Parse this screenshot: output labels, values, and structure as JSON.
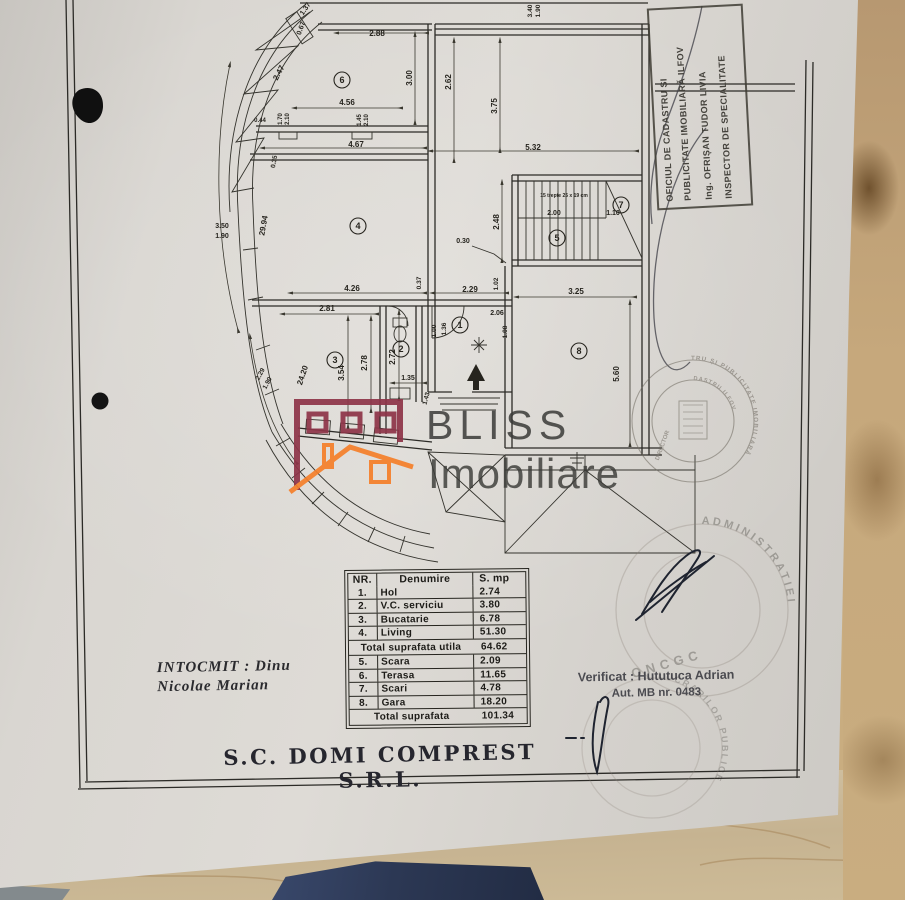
{
  "corner_stamp": {
    "line1": "OFICIUL DE CADASTRU ȘI",
    "line2": "PUBLICITATE IMOBILIARĂ ILFOV",
    "line3": "Ing. OFRIȘAN TUDOR LIVIA",
    "line4": "INSPECTOR DE SPECIALITATE"
  },
  "watermark": {
    "line1": "BLISS",
    "line2": "Imobiliare",
    "maroon": "#8e3448",
    "orange": "#f57f2a"
  },
  "table": {
    "headers": [
      "NR.",
      "Denumire",
      "S. mp"
    ],
    "rows": [
      {
        "nr": "1.",
        "name": "Hol",
        "mp": "2.74"
      },
      {
        "nr": "2.",
        "name": "V.C. serviciu",
        "mp": "3.80"
      },
      {
        "nr": "3.",
        "name": "Bucatarie",
        "mp": "6.78"
      },
      {
        "nr": "4.",
        "name": "Living",
        "mp": "51.30"
      }
    ],
    "subtotal": {
      "label": "Total suprafata utila",
      "mp": "64.62"
    },
    "rows2": [
      {
        "nr": "5.",
        "name": "Scara",
        "mp": "2.09"
      },
      {
        "nr": "6.",
        "name": "Terasa",
        "mp": "11.65"
      },
      {
        "nr": "7.",
        "name": "Scari",
        "mp": "4.78"
      },
      {
        "nr": "8.",
        "name": "Gara",
        "mp": "18.20"
      }
    ],
    "total": {
      "label": "Total suprafata",
      "mp": "101.34"
    }
  },
  "credits": {
    "intocmit_line1": "INTOCMIT : Dinu",
    "intocmit_line2": "Nicolae Marian",
    "verificat_line1": "Verificat : Hututuca Adrian",
    "verificat_line2": "Aut. MB nr. 0483"
  },
  "company": {
    "name": "S.C. DOMI COMPREST S.R.L."
  },
  "stamps": {
    "round1": {
      "outer": "AGENȚIA NAȚIONALĂ DE CADASTRU ȘI PUBLICITATE IMOBILIARĂ",
      "inner": "OFICIUL DE CADASTRU ILFOV",
      "center": "DIRECTOR"
    },
    "round2": {
      "arc": "ADMINISTRATIEI",
      "word": "ONCGC"
    },
    "round3": {
      "arc": "MINISTERUL LUCRARILOR PUBLICE"
    }
  },
  "plan": {
    "dimensions": [
      {
        "text": "1.37",
        "x": 307,
        "y": 10,
        "rot": -55,
        "size": 7
      },
      {
        "text": "0.67",
        "x": 303,
        "y": 29,
        "rot": -70,
        "size": 7
      },
      {
        "text": "2.88",
        "x": 377,
        "y": 36,
        "rot": 0
      },
      {
        "text": "2.47",
        "x": 281,
        "y": 74,
        "rot": -62
      },
      {
        "text": "3.00",
        "x": 412,
        "y": 78,
        "rot": -90
      },
      {
        "text": "2.62",
        "x": 451,
        "y": 82,
        "rot": -90
      },
      {
        "text": "3.75",
        "x": 497,
        "y": 106,
        "rot": -90
      },
      {
        "text": "3.40",
        "x": 532,
        "y": 11,
        "rot": -90,
        "size": 6.5
      },
      {
        "text": "1.90",
        "x": 540,
        "y": 11,
        "rot": -90,
        "size": 6.5
      },
      {
        "text": "4.56",
        "x": 347,
        "y": 105,
        "rot": 0
      },
      {
        "text": "1.70",
        "x": 282,
        "y": 119,
        "rot": -90,
        "size": 6
      },
      {
        "text": "2.10",
        "x": 289,
        "y": 119,
        "rot": -90,
        "size": 6
      },
      {
        "text": "1.45",
        "x": 361,
        "y": 120,
        "rot": -90,
        "size": 6
      },
      {
        "text": "2.10",
        "x": 368,
        "y": 120,
        "rot": -90,
        "size": 6
      },
      {
        "text": "0.44",
        "x": 260,
        "y": 122,
        "rot": 0,
        "size": 6
      },
      {
        "text": "4.67",
        "x": 356,
        "y": 147,
        "rot": 0
      },
      {
        "text": "5.32",
        "x": 533,
        "y": 150,
        "rot": 0
      },
      {
        "text": "0.35",
        "x": 276,
        "y": 162,
        "rot": -80,
        "size": 6.5
      },
      {
        "text": "3.50",
        "x": 222,
        "y": 228,
        "rot": 0,
        "size": 7
      },
      {
        "text": "1.90",
        "x": 222,
        "y": 238,
        "rot": 0,
        "size": 7
      },
      {
        "text": "29.94",
        "x": 266,
        "y": 226,
        "rot": -80
      },
      {
        "text": "2.48",
        "x": 499,
        "y": 222,
        "rot": -90
      },
      {
        "text": "15 trepte 25 x 19 cm",
        "x": 564,
        "y": 197,
        "rot": 0,
        "size": 5
      },
      {
        "text": "2.00",
        "x": 554,
        "y": 215,
        "rot": 0,
        "size": 7
      },
      {
        "text": "1.10",
        "x": 613,
        "y": 215,
        "rot": 0,
        "size": 7
      },
      {
        "text": "0.30",
        "x": 463,
        "y": 243,
        "rot": 0,
        "size": 7
      },
      {
        "text": "4.26",
        "x": 352,
        "y": 291,
        "rot": 0
      },
      {
        "text": "0.37",
        "x": 421,
        "y": 283,
        "rot": -90,
        "size": 6.5
      },
      {
        "text": "2.29",
        "x": 470,
        "y": 292,
        "rot": 0
      },
      {
        "text": "1.02",
        "x": 498,
        "y": 284,
        "rot": -90,
        "size": 6.5
      },
      {
        "text": "3.25",
        "x": 576,
        "y": 294,
        "rot": 0
      },
      {
        "text": "2.81",
        "x": 327,
        "y": 311,
        "rot": 0
      },
      {
        "text": "2.06",
        "x": 497,
        "y": 315,
        "rot": 0,
        "size": 7
      },
      {
        "text": "1.00",
        "x": 436,
        "y": 331,
        "rot": -90,
        "size": 6.5
      },
      {
        "text": "1.36",
        "x": 446,
        "y": 329,
        "rot": -90,
        "size": 6.5
      },
      {
        "text": "1.08",
        "x": 507,
        "y": 332,
        "rot": -90,
        "size": 6.5
      },
      {
        "text": "2.78",
        "x": 367,
        "y": 363,
        "rot": -90
      },
      {
        "text": "2.72",
        "x": 395,
        "y": 357,
        "rot": -90
      },
      {
        "text": "3.54",
        "x": 344,
        "y": 373,
        "rot": -90
      },
      {
        "text": "1.35",
        "x": 408,
        "y": 380,
        "rot": 0,
        "size": 7
      },
      {
        "text": "24.20",
        "x": 305,
        "y": 376,
        "rot": -72
      },
      {
        "text": "2.29",
        "x": 262,
        "y": 375,
        "rot": -62,
        "size": 6.5
      },
      {
        "text": "1.90",
        "x": 269,
        "y": 384,
        "rot": -62,
        "size": 6.5
      },
      {
        "text": "5.60",
        "x": 619,
        "y": 374,
        "rot": -90
      },
      {
        "text": "1.43",
        "x": 428,
        "y": 399,
        "rot": -75,
        "size": 6.5
      }
    ],
    "rooms": [
      {
        "n": "6",
        "x": 342,
        "y": 80
      },
      {
        "n": "4",
        "x": 358,
        "y": 226
      },
      {
        "n": "7",
        "x": 621,
        "y": 205
      },
      {
        "n": "5",
        "x": 557,
        "y": 238
      },
      {
        "n": "3",
        "x": 335,
        "y": 360
      },
      {
        "n": "2",
        "x": 401,
        "y": 349
      },
      {
        "n": "1",
        "x": 460,
        "y": 325
      },
      {
        "n": "8",
        "x": 579,
        "y": 351
      }
    ]
  }
}
